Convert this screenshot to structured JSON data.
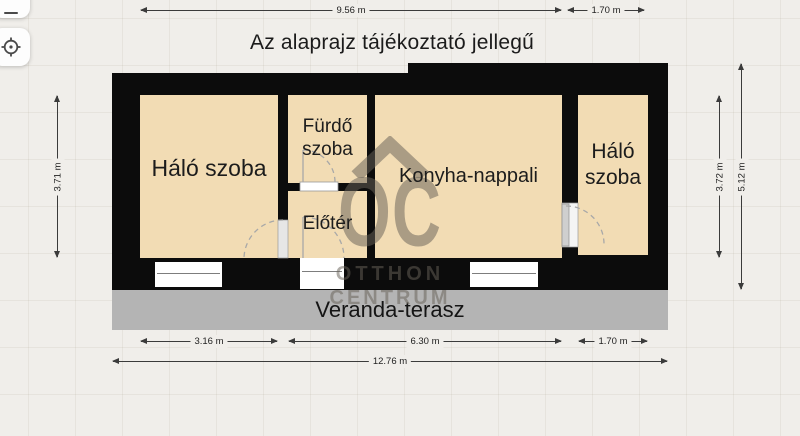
{
  "page": {
    "title": "Az alaprajz tájékoztató jellegű"
  },
  "toolbar": {
    "buttons": [
      {
        "id": "zoom-out",
        "icon": "minus-icon"
      },
      {
        "id": "locate",
        "icon": "target-icon"
      }
    ]
  },
  "floorplan": {
    "rooms": [
      {
        "id": "bedroom-left",
        "label": "Háló szoba"
      },
      {
        "id": "bathroom",
        "label": "Fürdő szoba"
      },
      {
        "id": "foyer",
        "label": "Előtér"
      },
      {
        "id": "kitchen-living",
        "label": "Konyha-nappali"
      },
      {
        "id": "bedroom-right",
        "label": "Háló szoba"
      },
      {
        "id": "veranda",
        "label": "Veranda-terasz"
      }
    ],
    "dimensions": {
      "top": [
        {
          "label": "9.56 m"
        },
        {
          "label": "1.70 m"
        }
      ],
      "left": [
        {
          "label": "3.71 m"
        }
      ],
      "right": [
        {
          "label": "3.72 m"
        },
        {
          "label": "5.12 m"
        }
      ],
      "bottom": [
        {
          "label": "3.16 m"
        },
        {
          "label": "6.30 m"
        },
        {
          "label": "1.70 m"
        }
      ],
      "total": {
        "label": "12.76 m"
      }
    },
    "watermark": {
      "logo": "OC",
      "line1": "OTTHON",
      "line2": "CENTRUM"
    },
    "colors": {
      "floor": "#f2dcb4",
      "wall": "#0c0c0c",
      "veranda": "#b4b4b4",
      "background": "#f0eeea",
      "watermark": "rgba(104,98,88,0.52)"
    }
  }
}
